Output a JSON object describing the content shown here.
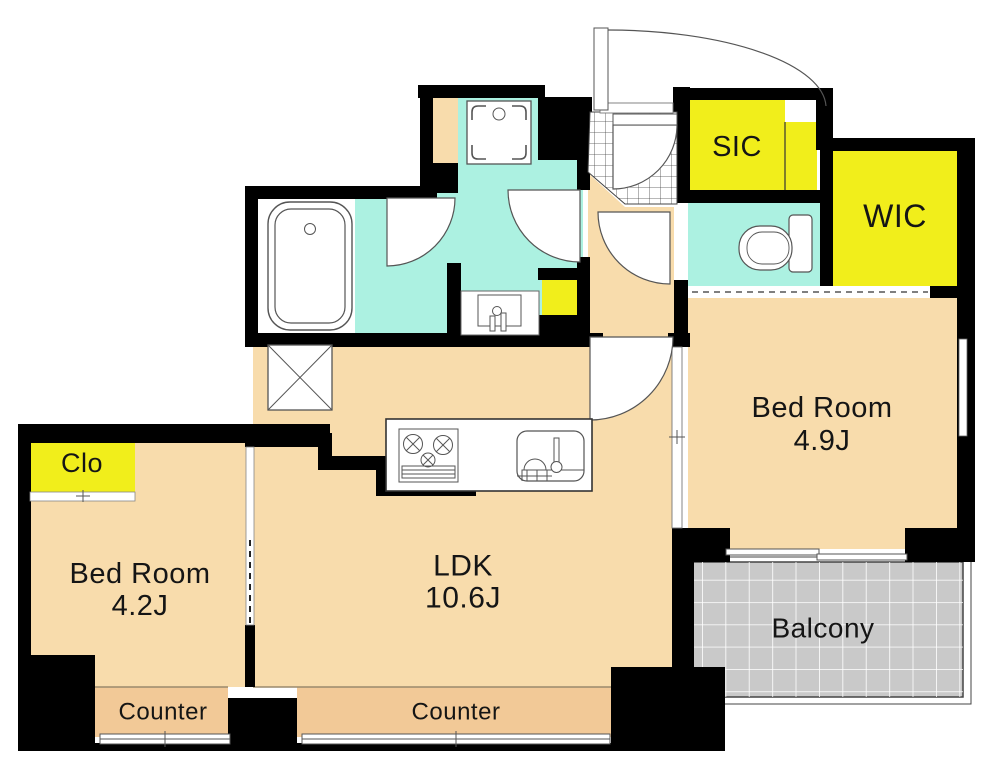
{
  "plan_type": "apartment-floor-plan",
  "palette": {
    "bg": "#FFFFFF",
    "wall": "#000000",
    "floor": "#F8DCAC",
    "counter": "#F2C997",
    "wet": "#ACF1E1",
    "storage": "#F1EE1B",
    "balcony": "#C9C9C9",
    "line": "#555555",
    "text": "#151515"
  },
  "rooms": {
    "ldk": {
      "label": "LDK",
      "size": "10.6J"
    },
    "bedroom_right": {
      "label": "Bed Room",
      "size": "4.9J"
    },
    "bedroom_left": {
      "label": "Bed Room",
      "size": "4.2J"
    },
    "balcony": {
      "label": "Balcony"
    },
    "sic": {
      "label": "SIC"
    },
    "wic": {
      "label": "WIC"
    },
    "closet": {
      "label": "Clo"
    }
  },
  "counter_labels": [
    "Counter",
    "Counter"
  ],
  "fixtures": [
    "bathtub",
    "washbasin",
    "washing-machine-pan",
    "toilet",
    "gas-stove",
    "kitchen-sink",
    "pipe-space",
    "entrance-door",
    "swing-doors",
    "sliding-windows",
    "balcony-grid",
    "genkan-tiles"
  ]
}
